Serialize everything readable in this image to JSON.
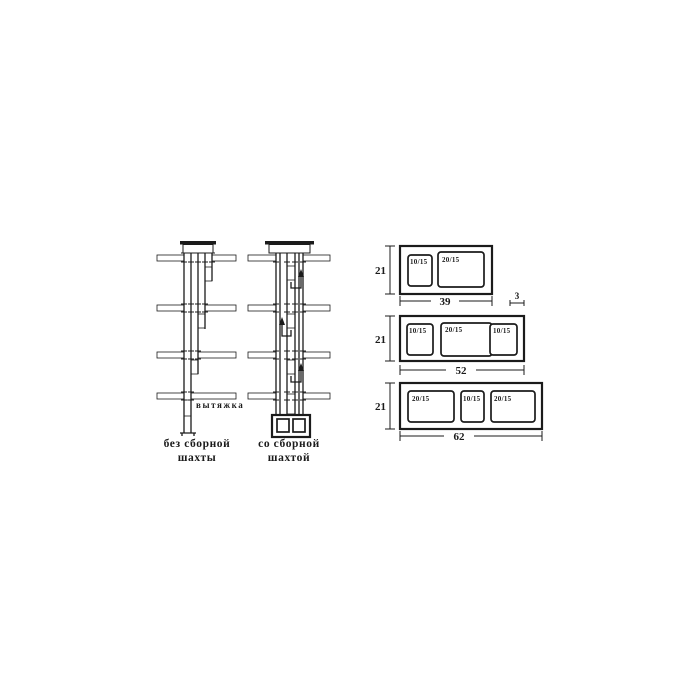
{
  "colors": {
    "ink": "#1b1b1b",
    "background": "#ffffff"
  },
  "shafts": {
    "vent_label": "вытяжка",
    "left": {
      "caption_line1": "без сборной",
      "caption_line2": "шахты"
    },
    "right": {
      "caption_line1": "со сборной",
      "caption_line2": "шахтой"
    }
  },
  "blocks": {
    "items": [
      {
        "height": "21",
        "width": "39",
        "wall_thickness": "3",
        "openings": [
          "10/15",
          "20/15"
        ]
      },
      {
        "height": "21",
        "width": "52",
        "openings": [
          "10/15",
          "20/15",
          "10/15"
        ]
      },
      {
        "height": "21",
        "width": "62",
        "openings": [
          "20/15",
          "10/15",
          "20/15"
        ]
      }
    ]
  }
}
